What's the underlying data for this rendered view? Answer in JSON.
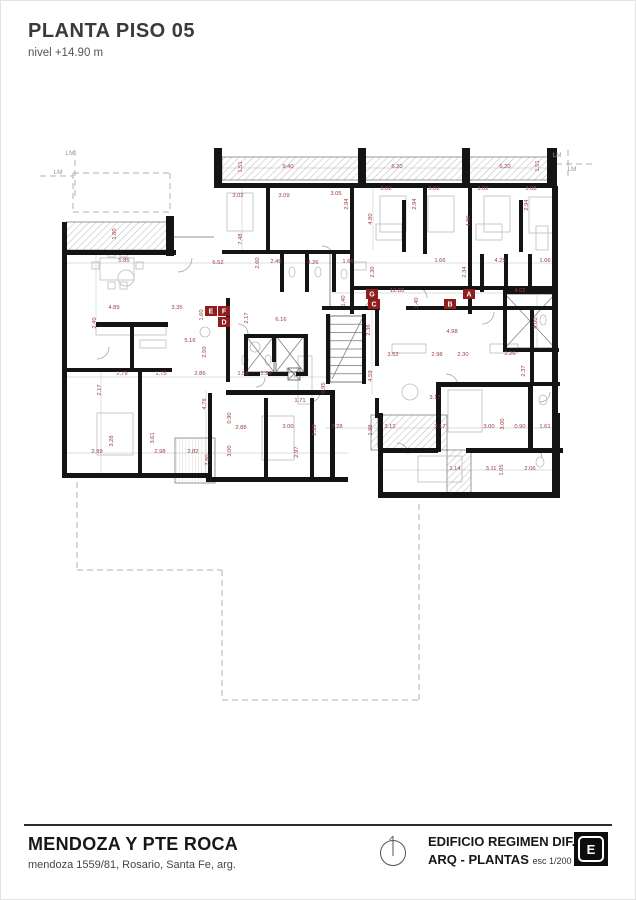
{
  "title": {
    "heading": "PLANTA PISO 05",
    "subtitle": "nivel +14.90 m"
  },
  "footer": {
    "project": "MENDOZA Y PTE ROCA",
    "address": "mendoza 1559/81, Rosario, Santa Fe, arg.",
    "building": "EDIFICIO REGIMEN DIF.",
    "sheet": "ARQ - PLANTAS",
    "scale": "esc 1/200",
    "logo_letter": "E"
  },
  "colors": {
    "wall": "#141414",
    "dim": "#9c3d3d",
    "marker_bg": "#8f1d1d",
    "marker_fg": "#ffffff",
    "light": "#bdbdbd",
    "hatch": "#9b9b9b",
    "dashed": "#b0b0b0",
    "dimline": "#d2d2d2",
    "gray_text": "#9a9a9a",
    "thin": "#6f6f6f"
  },
  "plan": {
    "lm_labels": [
      [
        "LM",
        70,
        155
      ],
      [
        "LM",
        58,
        174
      ],
      [
        "LM",
        557,
        157
      ],
      [
        "LM",
        572,
        171
      ]
    ],
    "markers": [
      [
        "E",
        211,
        311
      ],
      [
        "F",
        224,
        311
      ],
      [
        "D",
        224,
        322
      ],
      [
        "G",
        372,
        294
      ],
      [
        "A",
        469,
        294
      ],
      [
        "C",
        374,
        304
      ],
      [
        "B",
        450,
        304
      ]
    ],
    "dims": [
      [
        "1.51",
        242,
        167,
        90
      ],
      [
        "9.40",
        288,
        168,
        0
      ],
      [
        "6.20",
        397,
        168,
        0
      ],
      [
        "6.20",
        505,
        168,
        0
      ],
      [
        "1.51",
        539,
        166,
        90
      ],
      [
        "3.02",
        238,
        197,
        0
      ],
      [
        "3.09",
        284,
        197,
        0
      ],
      [
        "3.05",
        336,
        195,
        0
      ],
      [
        "2.94",
        348,
        204,
        90
      ],
      [
        "3.02",
        386,
        190,
        0
      ],
      [
        "3.02",
        434,
        190,
        0
      ],
      [
        "3.02",
        483,
        190,
        0
      ],
      [
        "3.08",
        531,
        190,
        0
      ],
      [
        "2.94",
        416,
        204,
        90
      ],
      [
        "2.94",
        528,
        205,
        90
      ],
      [
        "4.80",
        372,
        219,
        90
      ],
      [
        "4.80",
        470,
        221,
        90
      ],
      [
        "7.48",
        242,
        239,
        90
      ],
      [
        "1.80",
        116,
        234,
        90
      ],
      [
        "5.85",
        124,
        262,
        0
      ],
      [
        "6.52",
        218,
        264,
        0
      ],
      [
        "2.60",
        259,
        263,
        90
      ],
      [
        "2.49",
        276,
        263,
        0
      ],
      [
        "4.26",
        313,
        264,
        0
      ],
      [
        "1.66",
        348,
        263,
        0
      ],
      [
        "2.30",
        374,
        272,
        90
      ],
      [
        "4.25",
        500,
        262,
        0
      ],
      [
        "1.66",
        545,
        262,
        0
      ],
      [
        "1.66",
        440,
        262,
        0
      ],
      [
        "2.34",
        466,
        272,
        90
      ],
      [
        "12.83",
        397,
        292,
        0
      ],
      [
        "4.02",
        520,
        292,
        0
      ],
      [
        "1.40",
        345,
        301,
        90
      ],
      [
        "1.40",
        418,
        303,
        90
      ],
      [
        "6.16",
        281,
        321,
        0
      ],
      [
        "2.17",
        248,
        318,
        90
      ],
      [
        "4.89",
        114,
        309,
        0
      ],
      [
        "3.35",
        177,
        309,
        0
      ],
      [
        "2.40",
        96,
        323,
        90
      ],
      [
        "1.60",
        203,
        315,
        90
      ],
      [
        "5.16",
        190,
        342,
        0
      ],
      [
        "2.50",
        206,
        352,
        90
      ],
      [
        "4.00",
        537,
        323,
        90
      ],
      [
        "2.36",
        370,
        330,
        90
      ],
      [
        "4.98",
        452,
        333,
        0
      ],
      [
        "3.52",
        393,
        356,
        0
      ],
      [
        "2.98",
        437,
        356,
        0
      ],
      [
        "2.30",
        463,
        356,
        0
      ],
      [
        "2.26",
        510,
        355,
        0
      ],
      [
        "2.37",
        525,
        371,
        90
      ],
      [
        "4.59",
        372,
        376,
        90
      ],
      [
        "1.55",
        243,
        375,
        0
      ],
      [
        "1.94",
        266,
        375,
        0
      ],
      [
        "1.71",
        300,
        402,
        0
      ],
      [
        "0.95",
        325,
        388,
        90
      ],
      [
        "2.79",
        122,
        375,
        0
      ],
      [
        "1.75",
        161,
        375,
        0
      ],
      [
        "2.86",
        200,
        375,
        0
      ],
      [
        "2.17",
        101,
        390,
        90
      ],
      [
        "4.78",
        206,
        404,
        90
      ],
      [
        "0.90",
        231,
        418,
        90
      ],
      [
        "2.88",
        241,
        429,
        0
      ],
      [
        "3.00",
        288,
        428,
        0
      ],
      [
        "3.00",
        231,
        451,
        90
      ],
      [
        "2.97",
        298,
        452,
        90
      ],
      [
        "2.99",
        316,
        430,
        90
      ],
      [
        "2.99",
        97,
        453,
        0
      ],
      [
        "3.28",
        113,
        441,
        90
      ],
      [
        "3.61",
        154,
        438,
        90
      ],
      [
        "2.98",
        160,
        453,
        0
      ],
      [
        "2.82",
        193,
        453,
        0
      ],
      [
        "7.80",
        209,
        460,
        90
      ],
      [
        "3.17",
        435,
        399,
        0
      ],
      [
        "3.28",
        337,
        428,
        0
      ],
      [
        "1.98",
        372,
        430,
        90
      ],
      [
        "3.12",
        390,
        428,
        0
      ],
      [
        "3.17",
        440,
        428,
        0
      ],
      [
        "3.00",
        489,
        428,
        0
      ],
      [
        "3.00",
        504,
        424,
        90
      ],
      [
        "0.90",
        520,
        428,
        0
      ],
      [
        "1.61",
        545,
        428,
        0
      ],
      [
        "1.14",
        455,
        470,
        0
      ],
      [
        "3.11",
        491,
        470,
        0
      ],
      [
        "1.05",
        503,
        470,
        90
      ],
      [
        "2.06",
        530,
        470,
        0
      ]
    ],
    "walls": [
      [
        214,
        148,
        8,
        38
      ],
      [
        358,
        148,
        8,
        38
      ],
      [
        462,
        148,
        8,
        38
      ],
      [
        547,
        148,
        10,
        38
      ],
      [
        214,
        183,
        343,
        5
      ],
      [
        552,
        186,
        6,
        227
      ],
      [
        552,
        413,
        8,
        85
      ],
      [
        62,
        222,
        5,
        256
      ],
      [
        62,
        250,
        114,
        5
      ],
      [
        166,
        216,
        8,
        40
      ],
      [
        266,
        188,
        4,
        64
      ],
      [
        350,
        188,
        4,
        126
      ],
      [
        402,
        200,
        4,
        52
      ],
      [
        423,
        188,
        4,
        66
      ],
      [
        468,
        188,
        4,
        126
      ],
      [
        519,
        200,
        4,
        52
      ],
      [
        222,
        250,
        132,
        4
      ],
      [
        280,
        252,
        4,
        40
      ],
      [
        305,
        252,
        4,
        40
      ],
      [
        332,
        252,
        4,
        40
      ],
      [
        480,
        254,
        4,
        38
      ],
      [
        504,
        254,
        4,
        38
      ],
      [
        528,
        254,
        4,
        38
      ],
      [
        352,
        286,
        206,
        4
      ],
      [
        322,
        306,
        58,
        4
      ],
      [
        406,
        306,
        150,
        4
      ],
      [
        226,
        298,
        4,
        84
      ],
      [
        96,
        322,
        72,
        5
      ],
      [
        130,
        326,
        4,
        46
      ],
      [
        62,
        368,
        110,
        4
      ],
      [
        138,
        368,
        4,
        109
      ],
      [
        208,
        393,
        4,
        84
      ],
      [
        226,
        390,
        106,
        5
      ],
      [
        264,
        398,
        4,
        79
      ],
      [
        310,
        398,
        4,
        79
      ],
      [
        330,
        390,
        5,
        91
      ],
      [
        62,
        473,
        150,
        5
      ],
      [
        206,
        477,
        142,
        5
      ],
      [
        503,
        290,
        55,
        4
      ],
      [
        503,
        290,
        4,
        62
      ],
      [
        503,
        348,
        56,
        4
      ],
      [
        244,
        334,
        64,
        4
      ],
      [
        244,
        334,
        4,
        42
      ],
      [
        304,
        334,
        4,
        42
      ],
      [
        272,
        334,
        4,
        28
      ],
      [
        244,
        372,
        16,
        4
      ],
      [
        268,
        372,
        20,
        4
      ],
      [
        296,
        372,
        12,
        4
      ],
      [
        326,
        314,
        4,
        70
      ],
      [
        362,
        314,
        4,
        70
      ],
      [
        375,
        306,
        4,
        60
      ],
      [
        375,
        398,
        4,
        20
      ],
      [
        436,
        382,
        5,
        70
      ],
      [
        436,
        382,
        96,
        5
      ],
      [
        528,
        382,
        5,
        70
      ],
      [
        530,
        306,
        4,
        78
      ],
      [
        530,
        382,
        30,
        4
      ],
      [
        530,
        448,
        30,
        4
      ],
      [
        378,
        413,
        5,
        40
      ],
      [
        378,
        448,
        60,
        5
      ],
      [
        378,
        450,
        5,
        47
      ],
      [
        466,
        448,
        97,
        5
      ],
      [
        378,
        492,
        182,
        6
      ]
    ],
    "hatches": [
      [
        222,
        157,
        326,
        23
      ],
      [
        66,
        222,
        104,
        28
      ],
      [
        371,
        415,
        76,
        35
      ],
      [
        447,
        450,
        24,
        47
      ]
    ],
    "deck": [
      [
        175,
        438,
        40,
        45
      ]
    ],
    "tlines": [
      [
        174,
        237,
        214,
        237
      ],
      [
        330,
        252,
        330,
        306
      ],
      [
        378,
        413,
        378,
        448
      ]
    ],
    "dashes": [
      [
        75,
        150,
        75,
        196
      ],
      [
        40,
        176,
        73,
        176
      ],
      [
        73,
        173,
        170,
        173
      ],
      [
        73,
        212,
        170,
        212
      ],
      [
        73,
        173,
        73,
        212
      ],
      [
        170,
        173,
        170,
        212
      ],
      [
        556,
        164,
        592,
        164
      ],
      [
        568,
        150,
        568,
        180
      ],
      [
        77,
        482,
        77,
        570
      ],
      [
        77,
        570,
        222,
        570
      ],
      [
        222,
        570,
        222,
        700
      ],
      [
        222,
        700,
        419,
        700
      ],
      [
        419,
        700,
        419,
        500
      ]
    ],
    "dimlines": [
      [
        222,
        168,
        548,
        168
      ],
      [
        62,
        263,
        556,
        263
      ],
      [
        332,
        293,
        556,
        293
      ],
      [
        62,
        377,
        332,
        377
      ],
      [
        62,
        453,
        348,
        453
      ],
      [
        325,
        428,
        560,
        428
      ],
      [
        378,
        470,
        560,
        470
      ],
      [
        242,
        186,
        242,
        252
      ],
      [
        96,
        252,
        96,
        320
      ],
      [
        101,
        370,
        101,
        475
      ],
      [
        206,
        390,
        206,
        475
      ],
      [
        537,
        295,
        537,
        350
      ],
      [
        372,
        310,
        372,
        395
      ],
      [
        470,
        188,
        470,
        250
      ],
      [
        373,
        188,
        373,
        250
      ]
    ],
    "xboxes": [
      [
        505,
        294,
        50,
        54
      ],
      [
        246,
        336,
        28,
        36
      ],
      [
        276,
        336,
        28,
        36
      ],
      [
        288,
        368,
        12,
        12
      ]
    ],
    "stair": {
      "x": 330,
      "y": 316,
      "w": 34,
      "h": 66,
      "n": 8
    },
    "arcs": [
      [
        178,
        258,
        14,
        1
      ],
      [
        322,
        258,
        12,
        0
      ],
      [
        358,
        298,
        11,
        1
      ],
      [
        416,
        298,
        11,
        0
      ],
      [
        482,
        312,
        12,
        1
      ],
      [
        238,
        334,
        10,
        0
      ],
      [
        256,
        378,
        9,
        1
      ],
      [
        286,
        378,
        9,
        0
      ],
      [
        310,
        392,
        10,
        1
      ],
      [
        446,
        386,
        12,
        0
      ],
      [
        540,
        392,
        10,
        1
      ],
      [
        397,
        454,
        11,
        0
      ],
      [
        97,
        347,
        12,
        1
      ],
      [
        532,
        458,
        10,
        0
      ]
    ],
    "shapes": [
      [
        "r",
        100,
        258,
        34,
        22
      ],
      [
        "r",
        92,
        262,
        7,
        7
      ],
      [
        "r",
        136,
        262,
        7,
        7
      ],
      [
        "r",
        108,
        250,
        7,
        7
      ],
      [
        "r",
        120,
        250,
        7,
        7
      ],
      [
        "r",
        108,
        282,
        7,
        7
      ],
      [
        "r",
        120,
        282,
        7,
        7
      ],
      [
        "r",
        96,
        326,
        70,
        9
      ],
      [
        "r",
        140,
        340,
        26,
        8
      ],
      [
        "r",
        227,
        193,
        26,
        38
      ],
      [
        "r",
        380,
        196,
        26,
        36
      ],
      [
        "r",
        428,
        196,
        26,
        36
      ],
      [
        "r",
        484,
        196,
        26,
        36
      ],
      [
        "r",
        529,
        197,
        24,
        36
      ],
      [
        "r",
        376,
        224,
        26,
        16
      ],
      [
        "r",
        476,
        224,
        26,
        16
      ],
      [
        "r",
        97,
        413,
        36,
        42
      ],
      [
        "r",
        262,
        416,
        32,
        44
      ],
      [
        "r",
        448,
        390,
        34,
        42
      ],
      [
        "r",
        418,
        456,
        44,
        26
      ],
      [
        "r",
        298,
        356,
        14,
        48
      ],
      [
        "c",
        410,
        392,
        8
      ],
      [
        "c",
        126,
        278,
        8
      ],
      [
        "e",
        292,
        272,
        3,
        5
      ],
      [
        "e",
        318,
        272,
        3,
        5
      ],
      [
        "e",
        344,
        274,
        3,
        5
      ],
      [
        "e",
        543,
        320,
        3,
        5
      ],
      [
        "e",
        543,
        400,
        4,
        5
      ],
      [
        "e",
        540,
        462,
        4,
        5
      ],
      [
        "e",
        245,
        360,
        3,
        5
      ],
      [
        "e",
        268,
        360,
        3,
        5
      ],
      [
        "r",
        352,
        262,
        14,
        8
      ],
      [
        "r",
        392,
        344,
        34,
        9
      ],
      [
        "r",
        490,
        344,
        28,
        9
      ],
      [
        "c",
        205,
        332,
        5
      ],
      [
        "c",
        255,
        347,
        5
      ],
      [
        "r",
        536,
        226,
        12,
        24
      ]
    ]
  }
}
